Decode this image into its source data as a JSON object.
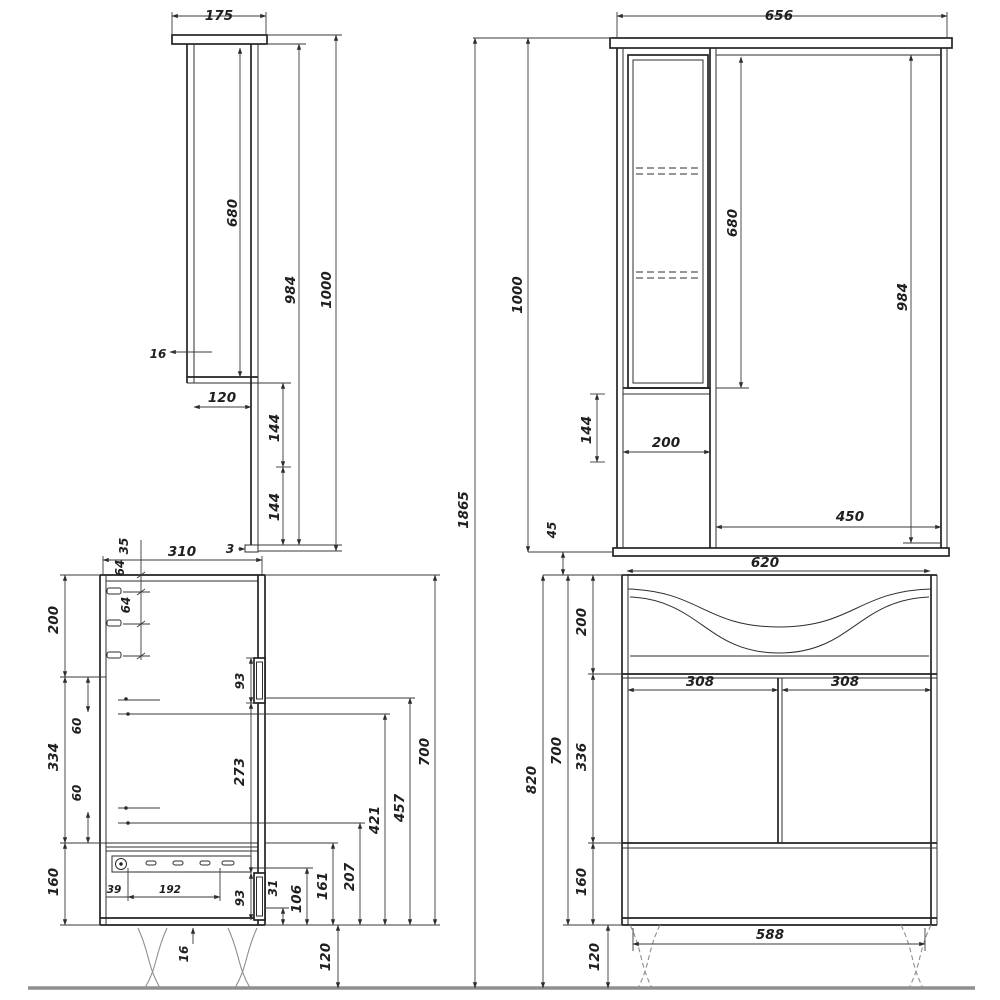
{
  "palette": {
    "line": "#232323",
    "dim": "#3a3a3a",
    "floor": "#8f8f8f",
    "background": "#ffffff"
  },
  "views": {
    "mirror_side": {
      "dims": {
        "width": "175",
        "interior_height": "680",
        "back_height": "984",
        "total_height": "1000",
        "wall": "16",
        "lower_depth": "120",
        "gap_upper": "144",
        "gap_lower": "144",
        "edge": "3"
      }
    },
    "mirror_front": {
      "dims": {
        "width": "656",
        "interior_height": "680",
        "mirror_height": "984",
        "total_height": "1000",
        "lower_gap": "144",
        "column_width": "200",
        "mirror_width": "450",
        "clearance": "45"
      }
    },
    "assembly": {
      "dims": {
        "total_height": "1865"
      }
    },
    "vanity_side": {
      "dims": {
        "depth": "310",
        "peg_offset": "35",
        "peg_gap1": "64",
        "peg_gap2": "64",
        "top_section": "200",
        "mid_section": "334",
        "bottom_section": "160",
        "screw_top": "60",
        "screw_bottom": "60",
        "hinge_top": "93",
        "hinge_span": "273",
        "hinge_bottom": "93",
        "rail_offset": "39",
        "rail_pitch": "192",
        "h31": "31",
        "h106": "106",
        "h161": "161",
        "h207": "207",
        "h421": "421",
        "h457": "457",
        "height": "700",
        "bottom_thickness": "16",
        "leg_height": "120"
      }
    },
    "vanity_front": {
      "dims": {
        "top_width": "620",
        "sink_section": "200",
        "door_left": "308",
        "door_right": "308",
        "door_section": "336",
        "bottom_section": "160",
        "height": "700",
        "total_height": "820",
        "base_width": "588",
        "leg_height": "120"
      }
    }
  }
}
